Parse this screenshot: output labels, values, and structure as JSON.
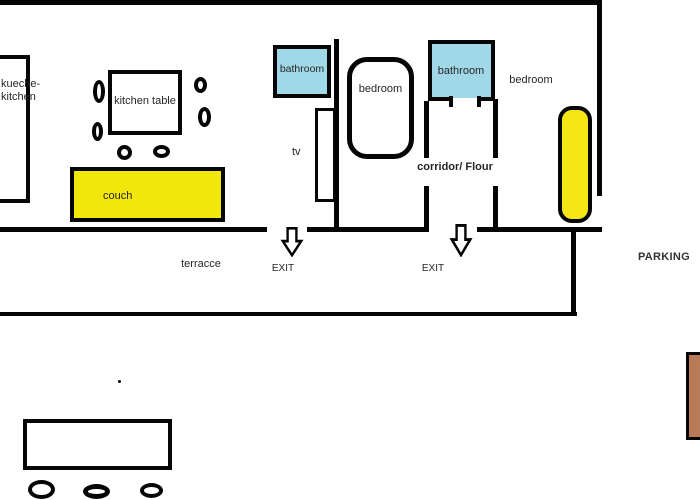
{
  "floorplan": {
    "rooms": {
      "kitchen": {
        "label_line1": "kueche-",
        "label_line2": "kitchen"
      },
      "kitchen_table": {
        "label": "kitchen table"
      },
      "couch": {
        "label": "couch",
        "fill": "#f2e70c"
      },
      "tv": {
        "label": "tv"
      },
      "bathroom_1": {
        "label": "bathroom",
        "fill": "#a0d8e8"
      },
      "bedroom_1": {
        "label": "bedroom"
      },
      "bathroom_2": {
        "label": "bathroom",
        "fill": "#a0d8e8"
      },
      "bedroom_2": {
        "label": "bedroom",
        "bed_fill": "#f5e616"
      },
      "corridor": {
        "label": "corridor/ Flour"
      }
    },
    "outside": {
      "terrace": {
        "label": "terracce"
      },
      "exit_1": {
        "label": "EXIT"
      },
      "exit_2": {
        "label": "EXIT"
      },
      "parking": {
        "label": "PARKING"
      },
      "mat_fill": "#b97a57"
    },
    "colors": {
      "wall": "#050505",
      "text": "#262626"
    }
  }
}
